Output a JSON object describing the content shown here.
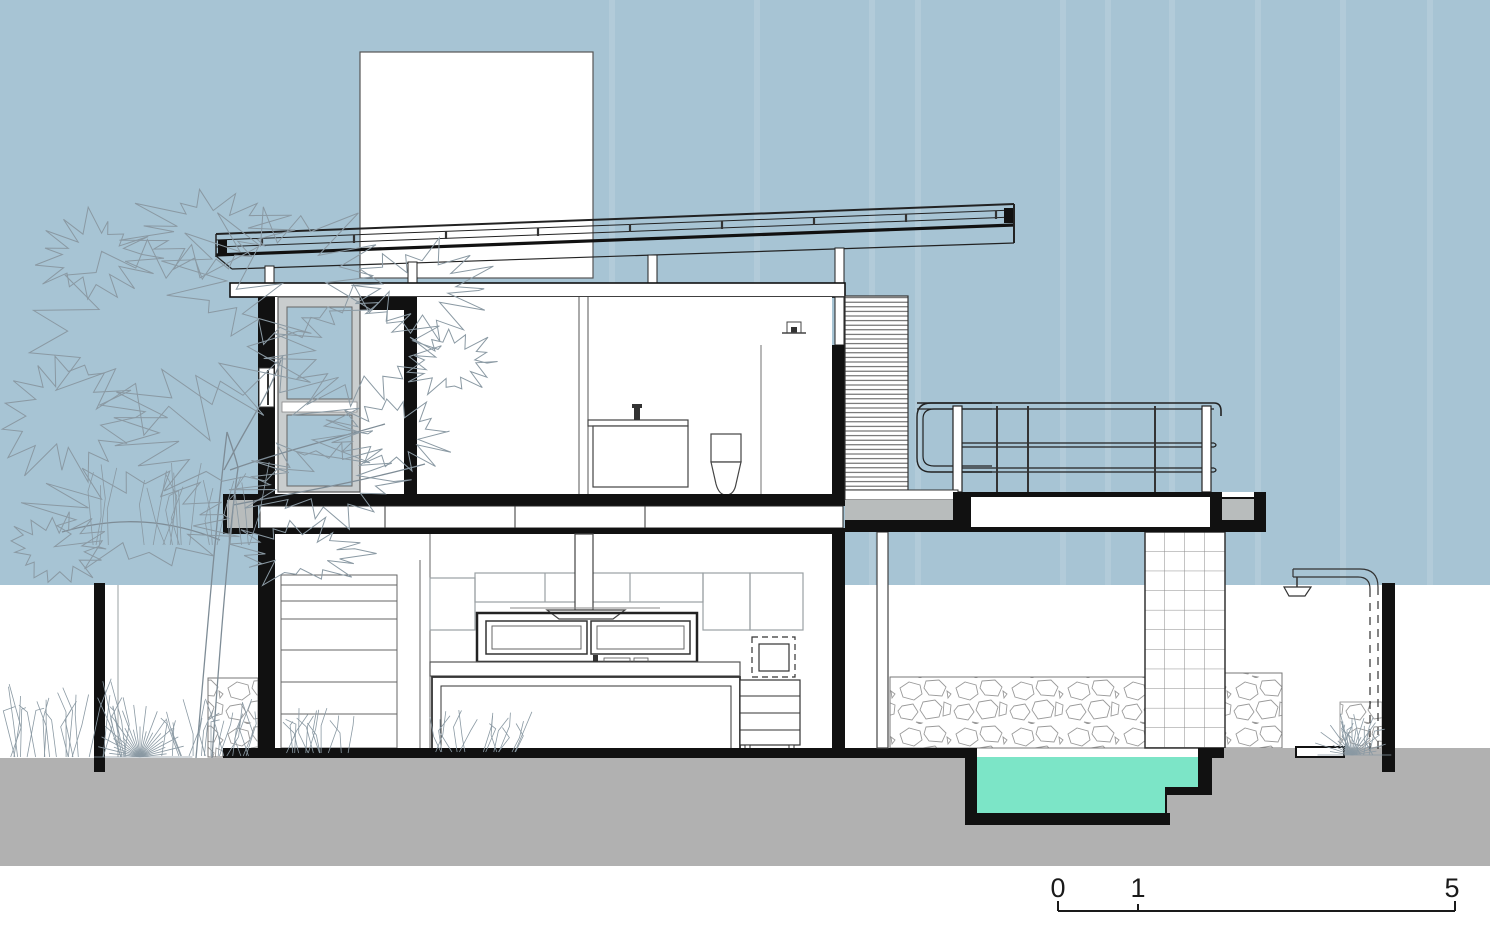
{
  "drawing": {
    "type": "architectural-cross-section",
    "scale_bar": {
      "labels": [
        "0",
        "1",
        "5"
      ]
    }
  },
  "colors": {
    "sky": "#a7c4d4",
    "ground": "#b1b1b1",
    "pool_water": "#7ce5c7",
    "waterline": "#ffffff",
    "cut_black": "#111111",
    "frame_gray": "#c9cdce",
    "deck_gray": "#b8bcbc",
    "paper": "#ffffff",
    "vegetation_line": "#8a99a3",
    "stone_line": "#9a9a9a",
    "tile_line": "#8a8a8a",
    "drawing_line": "#333333"
  }
}
